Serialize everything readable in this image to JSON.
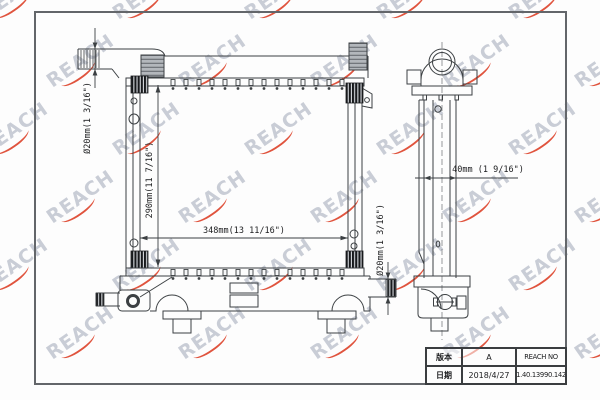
{
  "watermark": {
    "text": "REACH",
    "color": "#c9cdd6",
    "accent_color": "#e0543e"
  },
  "dimensions": {
    "inlet_diameter": "Ø20mm(1 3/16\")",
    "core_height": "290mm(11 7/16\")",
    "core_width": "348mm(13 11/16\")",
    "outlet_diameter": "Ø20mm(1 3/16\")",
    "side_depth": "40mm (1 9/16\")"
  },
  "title_block": {
    "version_label": "版本",
    "version_value": "A",
    "number_label": "REACH NO",
    "date_label": "日期",
    "date_value": "2018/4/27",
    "number_value": "1.40.13990.142"
  }
}
